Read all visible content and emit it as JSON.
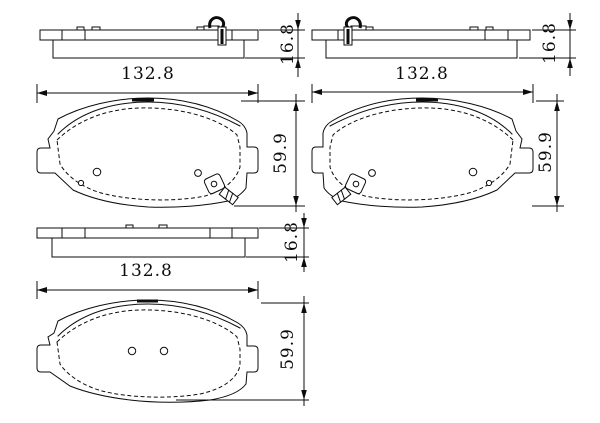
{
  "canvas": {
    "background": "#ffffff",
    "ink": "#0c0c0c"
  },
  "views": {
    "top_left": {
      "width": "132.8",
      "thickness": "16.8"
    },
    "top_right": {
      "width": "132.8",
      "thickness": "16.8"
    },
    "middle_left": {
      "height": "59.9"
    },
    "middle_right": {
      "height": "59.9"
    },
    "bottom": {
      "width": "132.8",
      "thickness": "16.8",
      "height": "59.9"
    }
  }
}
